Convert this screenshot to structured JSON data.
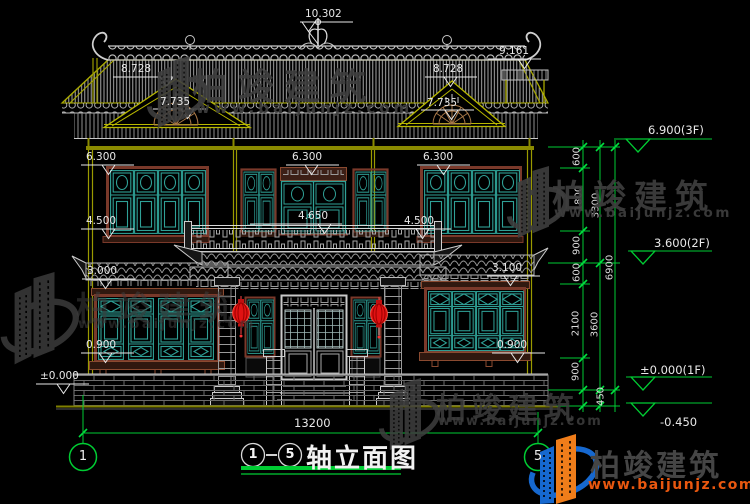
{
  "title": {
    "axis_start": "1",
    "axis_end": "5",
    "label": "轴立面图"
  },
  "axes": {
    "left": "1",
    "right": "5"
  },
  "watermark": {
    "brand": "柏竣建筑",
    "url": "www.baijunjz.com"
  },
  "levels": {
    "top": "10.302",
    "ridge_right": "9.161",
    "gable_left_ridge": "8.728",
    "gable_left_fan": "7.735",
    "gable_right_ridge": "8.728",
    "gable_right_fan": "7.735",
    "f2_left": "6.300",
    "f2_center": "6.300",
    "f2_right": "6.300",
    "sill2_left": "4.500",
    "balcony": "4.650",
    "sill2_right": "4.500",
    "f1_left": "3.000",
    "f1_right": "3.100",
    "sill1_left": "0.900",
    "sill1_right": "0.900",
    "ground_left": "±0.000",
    "right_3f": "6.900(3F)",
    "right_2f": "3.600(2F)",
    "right_1f": "±0.000(1F)",
    "right_base": "-0.450"
  },
  "dims": {
    "overall_width": "13200",
    "overall_height": "6900",
    "s600a": "600",
    "s1800": "1800",
    "s900a": "900",
    "s3300": "3300",
    "s600b": "600",
    "s2100": "2100",
    "s900b": "900",
    "s3600": "3600",
    "s450": "450"
  }
}
